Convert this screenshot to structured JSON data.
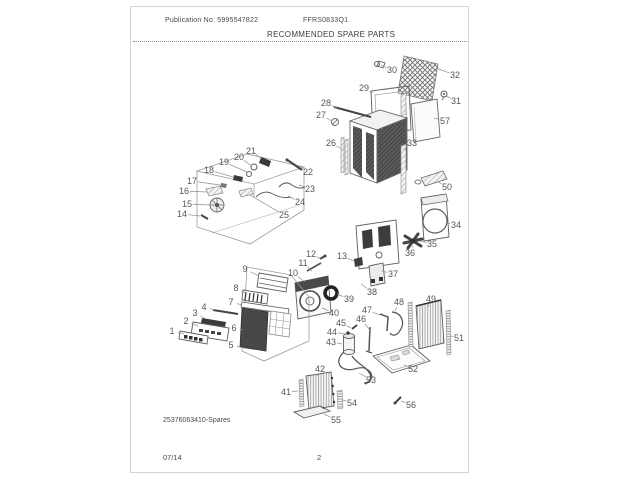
{
  "page": {
    "publication_no": "Publication No: 5995547822",
    "model": "FFRS0833Q1",
    "section_title": "RECOMMENDED SPARE PARTS",
    "diagram_id": "25376063410-Spares",
    "footer_date": "07/14",
    "footer_page": "2"
  },
  "colors": {
    "ink": "#4a4a4a",
    "leader_line": "#8f8f8f",
    "page_border": "#d4d4d4"
  },
  "diagram": {
    "description": "Exploded spare-parts view of room air conditioner",
    "callouts": [
      {
        "n": "1",
        "lx": 172,
        "ly": 331,
        "tx": 184,
        "ty": 334
      },
      {
        "n": "2",
        "lx": 186,
        "ly": 321,
        "tx": 198,
        "ty": 326
      },
      {
        "n": "3",
        "lx": 195,
        "ly": 313,
        "tx": 206,
        "ty": 319
      },
      {
        "n": "4",
        "lx": 204,
        "ly": 307,
        "tx": 215,
        "ty": 310
      },
      {
        "n": "5",
        "lx": 231,
        "ly": 345,
        "tx": 244,
        "ty": 348
      },
      {
        "n": "6",
        "lx": 234,
        "ly": 328,
        "tx": 243,
        "ty": 330
      },
      {
        "n": "7",
        "lx": 231,
        "ly": 302,
        "tx": 242,
        "ty": 305
      },
      {
        "n": "8",
        "lx": 236,
        "ly": 288,
        "tx": 245,
        "ty": 293
      },
      {
        "n": "9",
        "lx": 245,
        "ly": 269,
        "tx": 259,
        "ty": 276
      },
      {
        "n": "10",
        "lx": 293,
        "ly": 273,
        "tx": 305,
        "ty": 282
      },
      {
        "n": "11",
        "lx": 303,
        "ly": 263,
        "tx": 312,
        "ty": 271
      },
      {
        "n": "12",
        "lx": 311,
        "ly": 254,
        "tx": 321,
        "ty": 259
      },
      {
        "n": "13",
        "lx": 342,
        "ly": 256,
        "tx": 354,
        "ty": 261
      },
      {
        "n": "14",
        "lx": 182,
        "ly": 214,
        "tx": 200,
        "ty": 216
      },
      {
        "n": "15",
        "lx": 187,
        "ly": 204,
        "tx": 210,
        "ty": 205
      },
      {
        "n": "16",
        "lx": 184,
        "ly": 191,
        "tx": 207,
        "ty": 192
      },
      {
        "n": "17",
        "lx": 192,
        "ly": 181,
        "tx": 220,
        "ty": 185
      },
      {
        "n": "18",
        "lx": 209,
        "ly": 170,
        "tx": 233,
        "ty": 177
      },
      {
        "n": "19",
        "lx": 224,
        "ly": 162,
        "tx": 247,
        "ty": 172
      },
      {
        "n": "20",
        "lx": 239,
        "ly": 157,
        "tx": 252,
        "ty": 166
      },
      {
        "n": "21",
        "lx": 251,
        "ly": 151,
        "tx": 262,
        "ty": 159
      },
      {
        "n": "22",
        "lx": 308,
        "ly": 172,
        "tx": 299,
        "ty": 166
      },
      {
        "n": "23",
        "lx": 310,
        "ly": 189,
        "tx": 299,
        "ty": 185
      },
      {
        "n": "24",
        "lx": 300,
        "ly": 202,
        "tx": 288,
        "ty": 196
      },
      {
        "n": "25",
        "lx": 284,
        "ly": 215,
        "tx": 250,
        "ty": 195
      },
      {
        "n": "26",
        "lx": 331,
        "ly": 143,
        "tx": 342,
        "ty": 149
      },
      {
        "n": "27",
        "lx": 321,
        "ly": 115,
        "tx": 332,
        "ty": 121
      },
      {
        "n": "28",
        "lx": 326,
        "ly": 103,
        "tx": 337,
        "ty": 108
      },
      {
        "n": "29",
        "lx": 364,
        "ly": 88,
        "tx": 373,
        "ty": 93
      },
      {
        "n": "30",
        "lx": 392,
        "ly": 70,
        "tx": 381,
        "ty": 65
      },
      {
        "n": "31",
        "lx": 456,
        "ly": 101,
        "tx": 446,
        "ty": 96
      },
      {
        "n": "32",
        "lx": 455,
        "ly": 75,
        "tx": 436,
        "ty": 68
      },
      {
        "n": "33",
        "lx": 412,
        "ly": 143,
        "tx": 403,
        "ty": 150
      },
      {
        "n": "34",
        "lx": 456,
        "ly": 225,
        "tx": 447,
        "ty": 223
      },
      {
        "n": "35",
        "lx": 432,
        "ly": 244,
        "tx": 420,
        "ty": 241
      },
      {
        "n": "36",
        "lx": 410,
        "ly": 253,
        "tx": 413,
        "ty": 246
      },
      {
        "n": "37",
        "lx": 393,
        "ly": 274,
        "tx": 382,
        "ty": 271
      },
      {
        "n": "38",
        "lx": 372,
        "ly": 292,
        "tx": 361,
        "ty": 284
      },
      {
        "n": "39",
        "lx": 349,
        "ly": 299,
        "tx": 337,
        "ty": 294
      },
      {
        "n": "40",
        "lx": 334,
        "ly": 313,
        "tx": 322,
        "ty": 308
      },
      {
        "n": "41",
        "lx": 286,
        "ly": 392,
        "tx": 298,
        "ty": 391
      },
      {
        "n": "42",
        "lx": 320,
        "ly": 369,
        "tx": 317,
        "ty": 376
      },
      {
        "n": "43",
        "lx": 331,
        "ly": 342,
        "tx": 342,
        "ty": 344
      },
      {
        "n": "44",
        "lx": 332,
        "ly": 332,
        "tx": 346,
        "ty": 334
      },
      {
        "n": "45",
        "lx": 341,
        "ly": 323,
        "tx": 351,
        "ty": 328
      },
      {
        "n": "46",
        "lx": 361,
        "ly": 319,
        "tx": 369,
        "ty": 329
      },
      {
        "n": "47",
        "lx": 367,
        "ly": 310,
        "tx": 380,
        "ty": 315
      },
      {
        "n": "48",
        "lx": 399,
        "ly": 302,
        "tx": 395,
        "ty": 311
      },
      {
        "n": "49",
        "lx": 431,
        "ly": 299,
        "tx": 428,
        "ty": 307
      },
      {
        "n": "50",
        "lx": 447,
        "ly": 187,
        "tx": 438,
        "ty": 182
      },
      {
        "n": "51",
        "lx": 459,
        "ly": 338,
        "tx": 451,
        "ty": 336
      },
      {
        "n": "52",
        "lx": 413,
        "ly": 369,
        "tx": 404,
        "ty": 365
      },
      {
        "n": "53",
        "lx": 371,
        "ly": 380,
        "tx": 359,
        "ty": 373
      },
      {
        "n": "54",
        "lx": 352,
        "ly": 403,
        "tx": 343,
        "ty": 400
      },
      {
        "n": "55",
        "lx": 336,
        "ly": 420,
        "tx": 324,
        "ty": 414
      },
      {
        "n": "56",
        "lx": 411,
        "ly": 405,
        "tx": 401,
        "ty": 401
      },
      {
        "n": "57",
        "lx": 445,
        "ly": 121,
        "tx": 434,
        "ty": 118
      }
    ]
  }
}
